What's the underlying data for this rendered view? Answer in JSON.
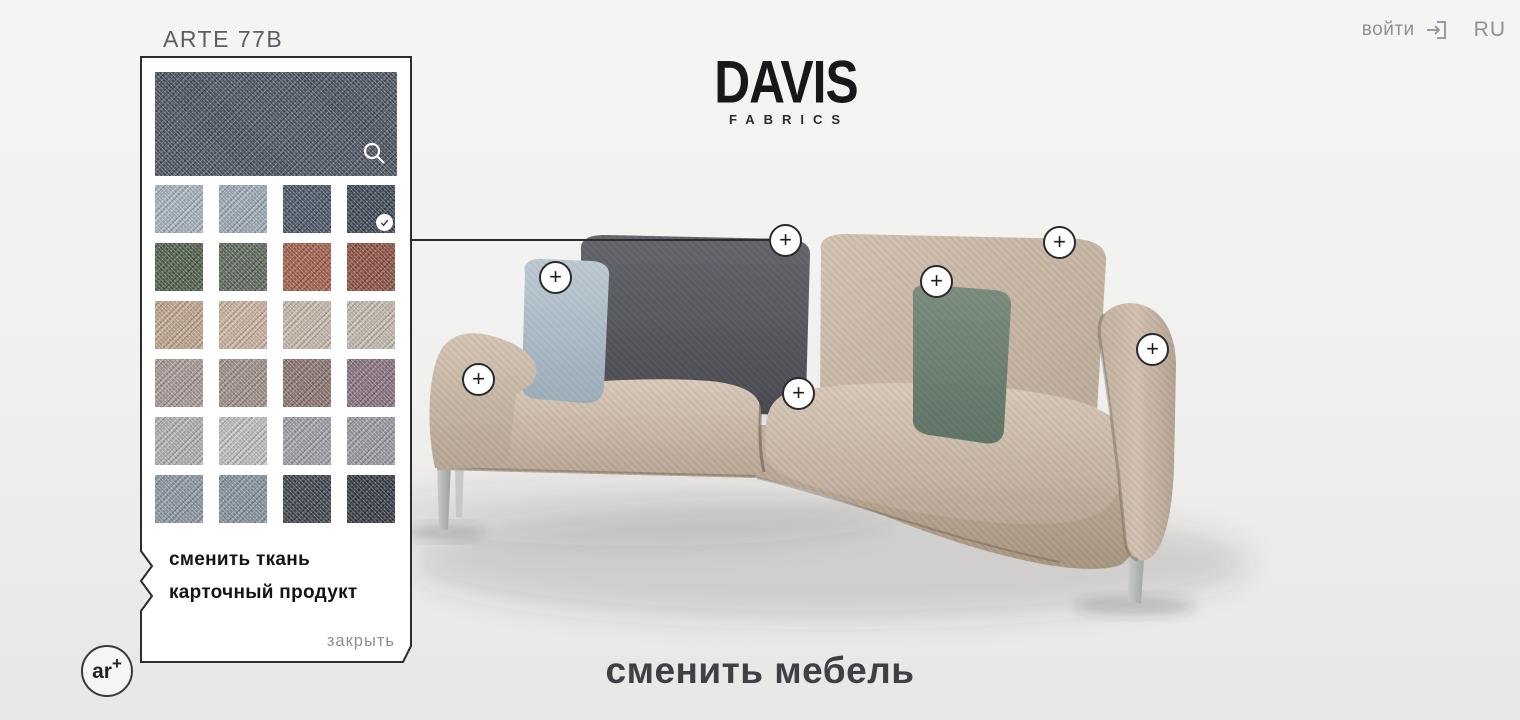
{
  "header": {
    "login_label": "войти",
    "language": "RU"
  },
  "brand": {
    "name": "DAVIS",
    "tagline": "FABRICS"
  },
  "fabric_panel": {
    "title": "ARTE 77B",
    "preview": {
      "color": "#4d5662",
      "zoom_icon": "magnifier"
    },
    "swatches": [
      {
        "color": "#a9b5c1"
      },
      {
        "color": "#9fadba"
      },
      {
        "color": "#4c5768"
      },
      {
        "color": "#3e4857",
        "selected": true
      },
      {
        "color": "#50604d"
      },
      {
        "color": "#5e6a5c"
      },
      {
        "color": "#a5614c"
      },
      {
        "color": "#8f5043"
      },
      {
        "color": "#c2a88e"
      },
      {
        "color": "#cfb4a2"
      },
      {
        "color": "#c9bcae"
      },
      {
        "color": "#c6bdb3"
      },
      {
        "color": "#a99b97"
      },
      {
        "color": "#a1918a"
      },
      {
        "color": "#8d7571"
      },
      {
        "color": "#8a7380"
      },
      {
        "color": "#b1b3b5"
      },
      {
        "color": "#c0c2c4"
      },
      {
        "color": "#a0a2a7"
      },
      {
        "color": "#9b9da2"
      },
      {
        "color": "#8e99a4"
      },
      {
        "color": "#8894a0"
      },
      {
        "color": "#40444d"
      },
      {
        "color": "#363a43"
      }
    ],
    "actions": {
      "change_fabric": "сменить ткань",
      "product_card": "карточный продукт",
      "close": "закрыть"
    }
  },
  "scene": {
    "hotspot_symbol": "+",
    "hotspots": [
      {
        "name": "hotspot-back-cushion-left",
        "x": 786,
        "y": 241
      },
      {
        "name": "hotspot-back-cushion-right",
        "x": 1060,
        "y": 243
      },
      {
        "name": "hotspot-pillow-left",
        "x": 556,
        "y": 278
      },
      {
        "name": "hotspot-pillow-right",
        "x": 937,
        "y": 282
      },
      {
        "name": "hotspot-armrest-right",
        "x": 1153,
        "y": 350
      },
      {
        "name": "hotspot-armrest-left",
        "x": 479,
        "y": 380
      },
      {
        "name": "hotspot-seat-cushion",
        "x": 799,
        "y": 394
      }
    ],
    "change_furniture_label": "сменить мебель",
    "ar_button": {
      "text": "ar",
      "plus": "+"
    }
  }
}
